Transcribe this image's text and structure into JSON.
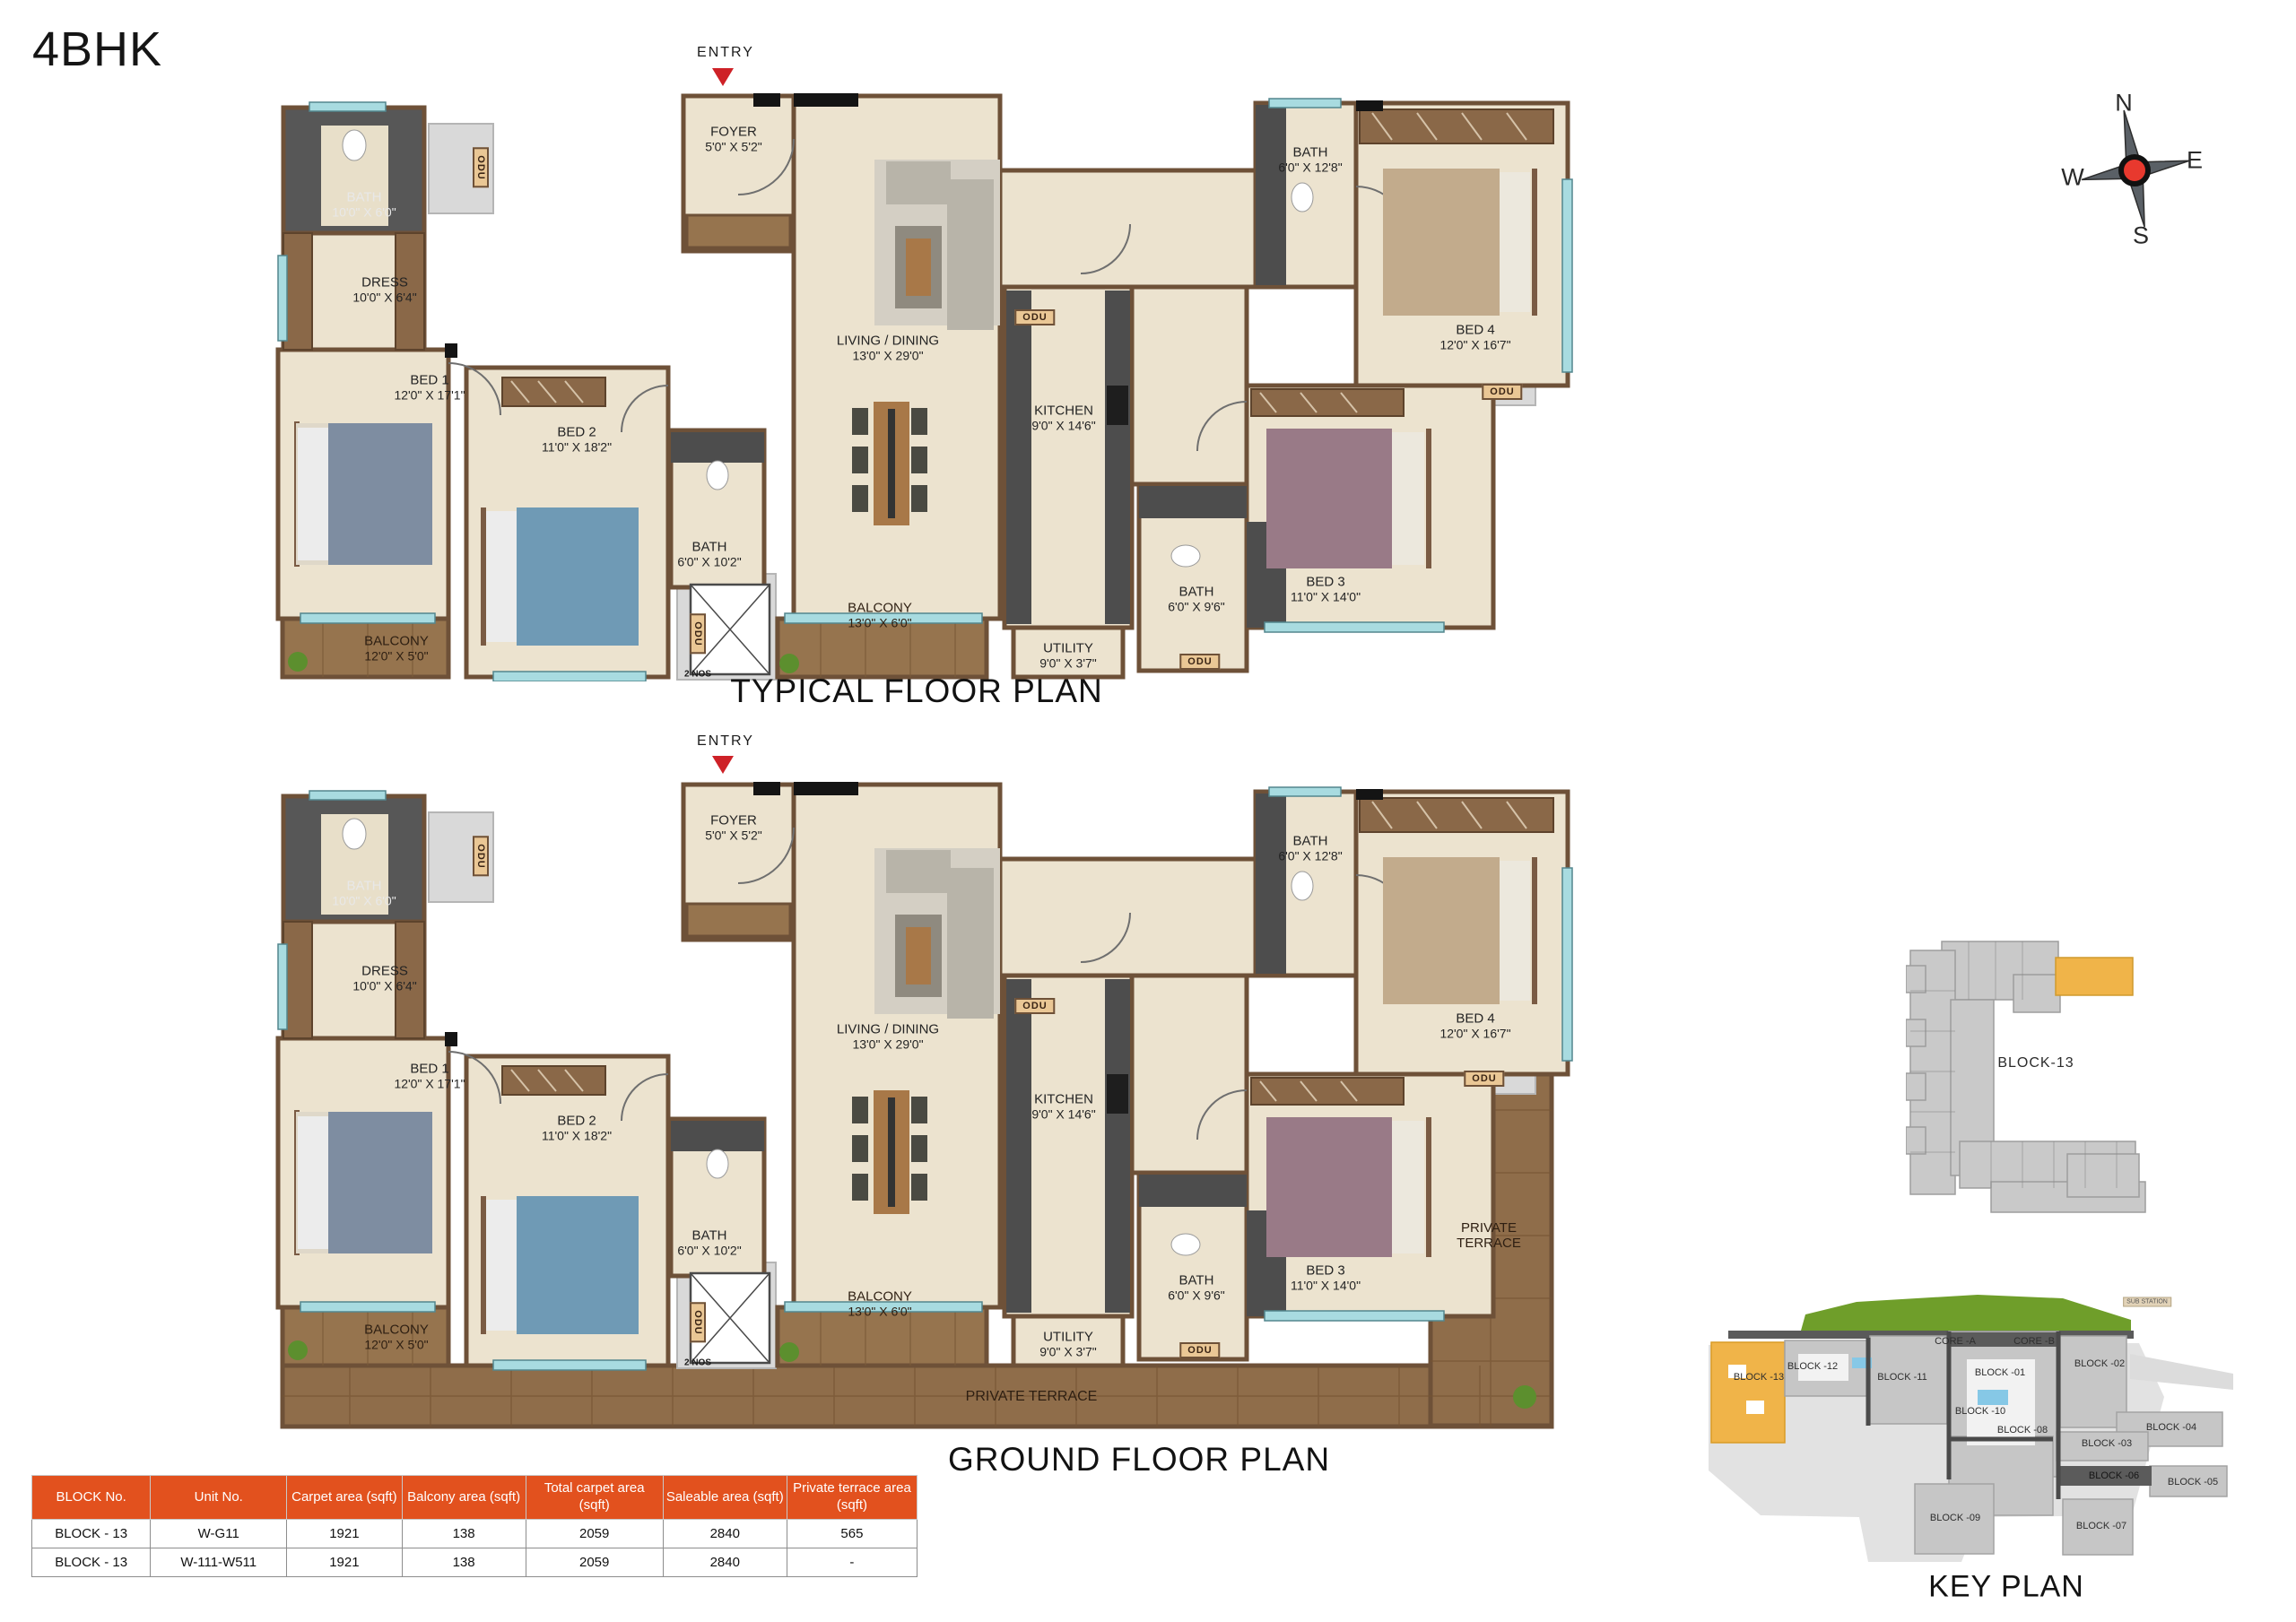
{
  "title": "4BHK",
  "plans": {
    "typical": {
      "caption": "TYPICAL FLOOR PLAN",
      "entry": "ENTRY"
    },
    "ground": {
      "caption": "GROUND FLOOR PLAN",
      "entry": "ENTRY"
    }
  },
  "rooms": {
    "bath1": {
      "name": "BATH",
      "dim": "10'0\" X 6'0\""
    },
    "dress": {
      "name": "DRESS",
      "dim": "10'0\" X 6'4\""
    },
    "bed1": {
      "name": "BED 1",
      "dim": "12'0\" X 17'1\""
    },
    "balcony1": {
      "name": "BALCONY",
      "dim": "12'0\" X 5'0\""
    },
    "bed2": {
      "name": "BED 2",
      "dim": "11'0\" X 18'2\""
    },
    "bath2": {
      "name": "BATH",
      "dim": "6'0\" X 10'2\""
    },
    "foyer": {
      "name": "FOYER",
      "dim": "5'0\" X 5'2\""
    },
    "living": {
      "name": "LIVING / DINING",
      "dim": "13'0\" X 29'0\""
    },
    "balcony2": {
      "name": "BALCONY",
      "dim": "13'0\" X 6'0\""
    },
    "kitchen": {
      "name": "KITCHEN",
      "dim": "9'0\" X 14'6\""
    },
    "utility": {
      "name": "UTILITY",
      "dim": "9'0\" X 3'7\""
    },
    "bath3": {
      "name": "BATH",
      "dim": "6'0\" X 12'8\""
    },
    "bed4": {
      "name": "BED 4",
      "dim": "12'0\" X 16'7\""
    },
    "bath4": {
      "name": "BATH",
      "dim": "6'0\" X 9'6\""
    },
    "bed3": {
      "name": "BED 3",
      "dim": "11'0\" X 14'0\""
    },
    "odu": "ODU",
    "two_nos": "2 NOS",
    "terrace": {
      "line1": "PRIVATE",
      "line2": "TERRACE",
      "full": "PRIVATE TERRACE"
    }
  },
  "compass": {
    "n": "N",
    "e": "E",
    "s": "S",
    "w": "W"
  },
  "mini_plan": {
    "label": "BLOCK-13"
  },
  "key_plan": {
    "caption": "KEY PLAN",
    "sub_station": "SUB STATION",
    "core_a": "CORE -A",
    "core_b": "CORE -B",
    "b01": "BLOCK -01",
    "b02": "BLOCK -02",
    "b03": "BLOCK -03",
    "b04": "BLOCK -04",
    "b05": "BLOCK -05",
    "b06": "BLOCK -06",
    "b07": "BLOCK -07",
    "b08": "BLOCK -08",
    "b09": "BLOCK -09",
    "b10": "BLOCK -10",
    "b11": "BLOCK -11",
    "b12": "BLOCK -12",
    "b13": "BLOCK -13"
  },
  "table": {
    "headers": [
      "BLOCK No.",
      "Unit No.",
      "Carpet area (sqft)",
      "Balcony area (sqft)",
      "Total carpet area (sqft)",
      "Saleable area (sqft)",
      "Private terrace area (sqft)"
    ],
    "rows": [
      [
        "BLOCK - 13",
        "W-G11",
        "1921",
        "138",
        "2059",
        "2840",
        "565"
      ],
      [
        "BLOCK - 13",
        "W-111-W511",
        "1921",
        "138",
        "2059",
        "2840",
        "-"
      ]
    ]
  },
  "colors": {
    "header_orange": "#e2511e",
    "entry_red": "#ce2127",
    "wall_brown": "#6e5138",
    "floor_beige": "#ece3cf",
    "wood": "#96744e",
    "bath_dark": "#575757",
    "highlight_orange": "#f0b449",
    "green": "#6f9e2a"
  }
}
